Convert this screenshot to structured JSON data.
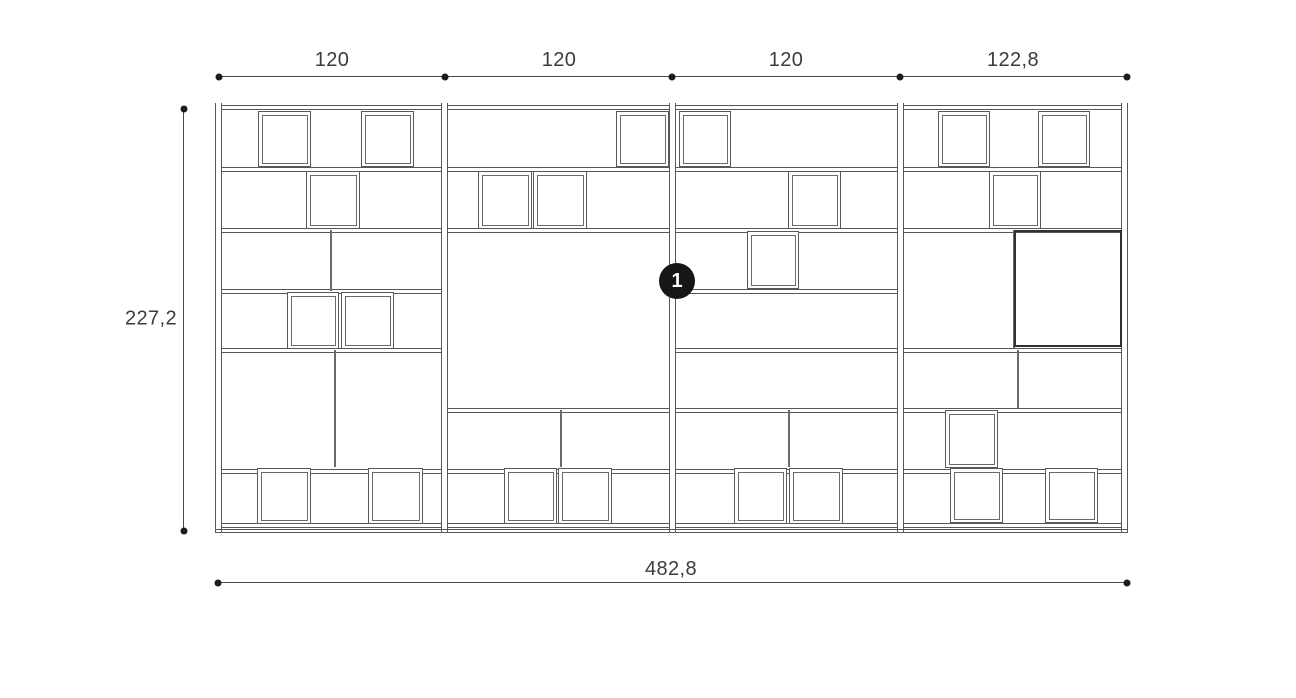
{
  "drawing": {
    "background": "#ffffff",
    "line_color": "#585858",
    "dim_color": "#4a4a4a",
    "text_color": "#3c3c3c",
    "callout_bg": "#161616",
    "callout_fg": "#ffffff",
    "panels": {
      "xs": [
        215,
        441,
        669,
        897,
        1121
      ],
      "y0": 103,
      "y1": 533,
      "w": 7
    },
    "shelves": [
      {
        "x0": 222,
        "x1": 441,
        "ys": [
          105,
          167,
          228,
          289,
          348,
          469,
          523
        ]
      },
      {
        "x0": 448,
        "x1": 669,
        "ys": [
          105,
          167,
          228,
          408,
          469,
          523
        ]
      },
      {
        "x0": 676,
        "x1": 897,
        "ys": [
          105,
          167,
          228,
          289,
          348,
          408,
          469,
          523
        ]
      },
      {
        "x0": 904,
        "x1": 1121,
        "ys": [
          105,
          167,
          228,
          348,
          408,
          469,
          523
        ]
      }
    ],
    "base": {
      "x0": 215,
      "x1": 1128,
      "y": 529
    },
    "dividers": [
      {
        "x": 330,
        "y0": 230,
        "y1": 291
      },
      {
        "x": 334,
        "y0": 350,
        "y1": 467
      },
      {
        "x": 560,
        "y0": 410,
        "y1": 467
      },
      {
        "x": 788,
        "y0": 410,
        "y1": 467
      },
      {
        "x": 1013,
        "y0": 230,
        "y1": 348
      },
      {
        "x": 1017,
        "y0": 350,
        "y1": 408
      }
    ],
    "boxes": [
      {
        "x": 258,
        "y": 111,
        "w": 53,
        "h": 56
      },
      {
        "x": 361,
        "y": 111,
        "w": 53,
        "h": 56
      },
      {
        "x": 306,
        "y": 171,
        "w": 54,
        "h": 58
      },
      {
        "x": 287,
        "y": 292,
        "w": 52,
        "h": 57
      },
      {
        "x": 341,
        "y": 292,
        "w": 53,
        "h": 57
      },
      {
        "x": 257,
        "y": 468,
        "w": 54,
        "h": 56
      },
      {
        "x": 368,
        "y": 468,
        "w": 55,
        "h": 56
      },
      {
        "x": 616,
        "y": 111,
        "w": 53,
        "h": 56
      },
      {
        "x": 478,
        "y": 171,
        "w": 54,
        "h": 58
      },
      {
        "x": 533,
        "y": 171,
        "w": 54,
        "h": 58
      },
      {
        "x": 504,
        "y": 468,
        "w": 53,
        "h": 56
      },
      {
        "x": 558,
        "y": 468,
        "w": 54,
        "h": 56
      },
      {
        "x": 679,
        "y": 111,
        "w": 52,
        "h": 56
      },
      {
        "x": 788,
        "y": 171,
        "w": 53,
        "h": 58
      },
      {
        "x": 747,
        "y": 231,
        "w": 52,
        "h": 58
      },
      {
        "x": 734,
        "y": 468,
        "w": 53,
        "h": 56
      },
      {
        "x": 789,
        "y": 468,
        "w": 54,
        "h": 56
      },
      {
        "x": 938,
        "y": 111,
        "w": 52,
        "h": 56
      },
      {
        "x": 1038,
        "y": 111,
        "w": 52,
        "h": 56
      },
      {
        "x": 989,
        "y": 171,
        "w": 52,
        "h": 58
      },
      {
        "x": 945,
        "y": 410,
        "w": 53,
        "h": 58
      },
      {
        "x": 950,
        "y": 468,
        "w": 53,
        "h": 55
      },
      {
        "x": 1045,
        "y": 468,
        "w": 53,
        "h": 55
      }
    ],
    "feature_box": {
      "x": 1014,
      "y": 230,
      "w": 108,
      "h": 117
    }
  },
  "callout": {
    "label": "1",
    "cx": 677,
    "cy": 281,
    "d": 36
  },
  "dims": {
    "top": {
      "y": 76,
      "x0": 219,
      "x1": 1127,
      "dots": [
        219,
        445,
        672,
        900,
        1127
      ],
      "labels": [
        {
          "text": "120",
          "cx": 332,
          "y": 72
        },
        {
          "text": "120",
          "cx": 559,
          "y": 72
        },
        {
          "text": "120",
          "cx": 786,
          "y": 72
        },
        {
          "text": "122,8",
          "cx": 1013,
          "y": 72
        }
      ]
    },
    "left": {
      "x": 183,
      "y0": 109,
      "y1": 531,
      "label": "227,2",
      "lx": 177,
      "ly": 319
    },
    "bottom": {
      "y": 582,
      "x0": 218,
      "x1": 1127,
      "label": "482,8",
      "lx": 671,
      "ly": 581
    }
  }
}
